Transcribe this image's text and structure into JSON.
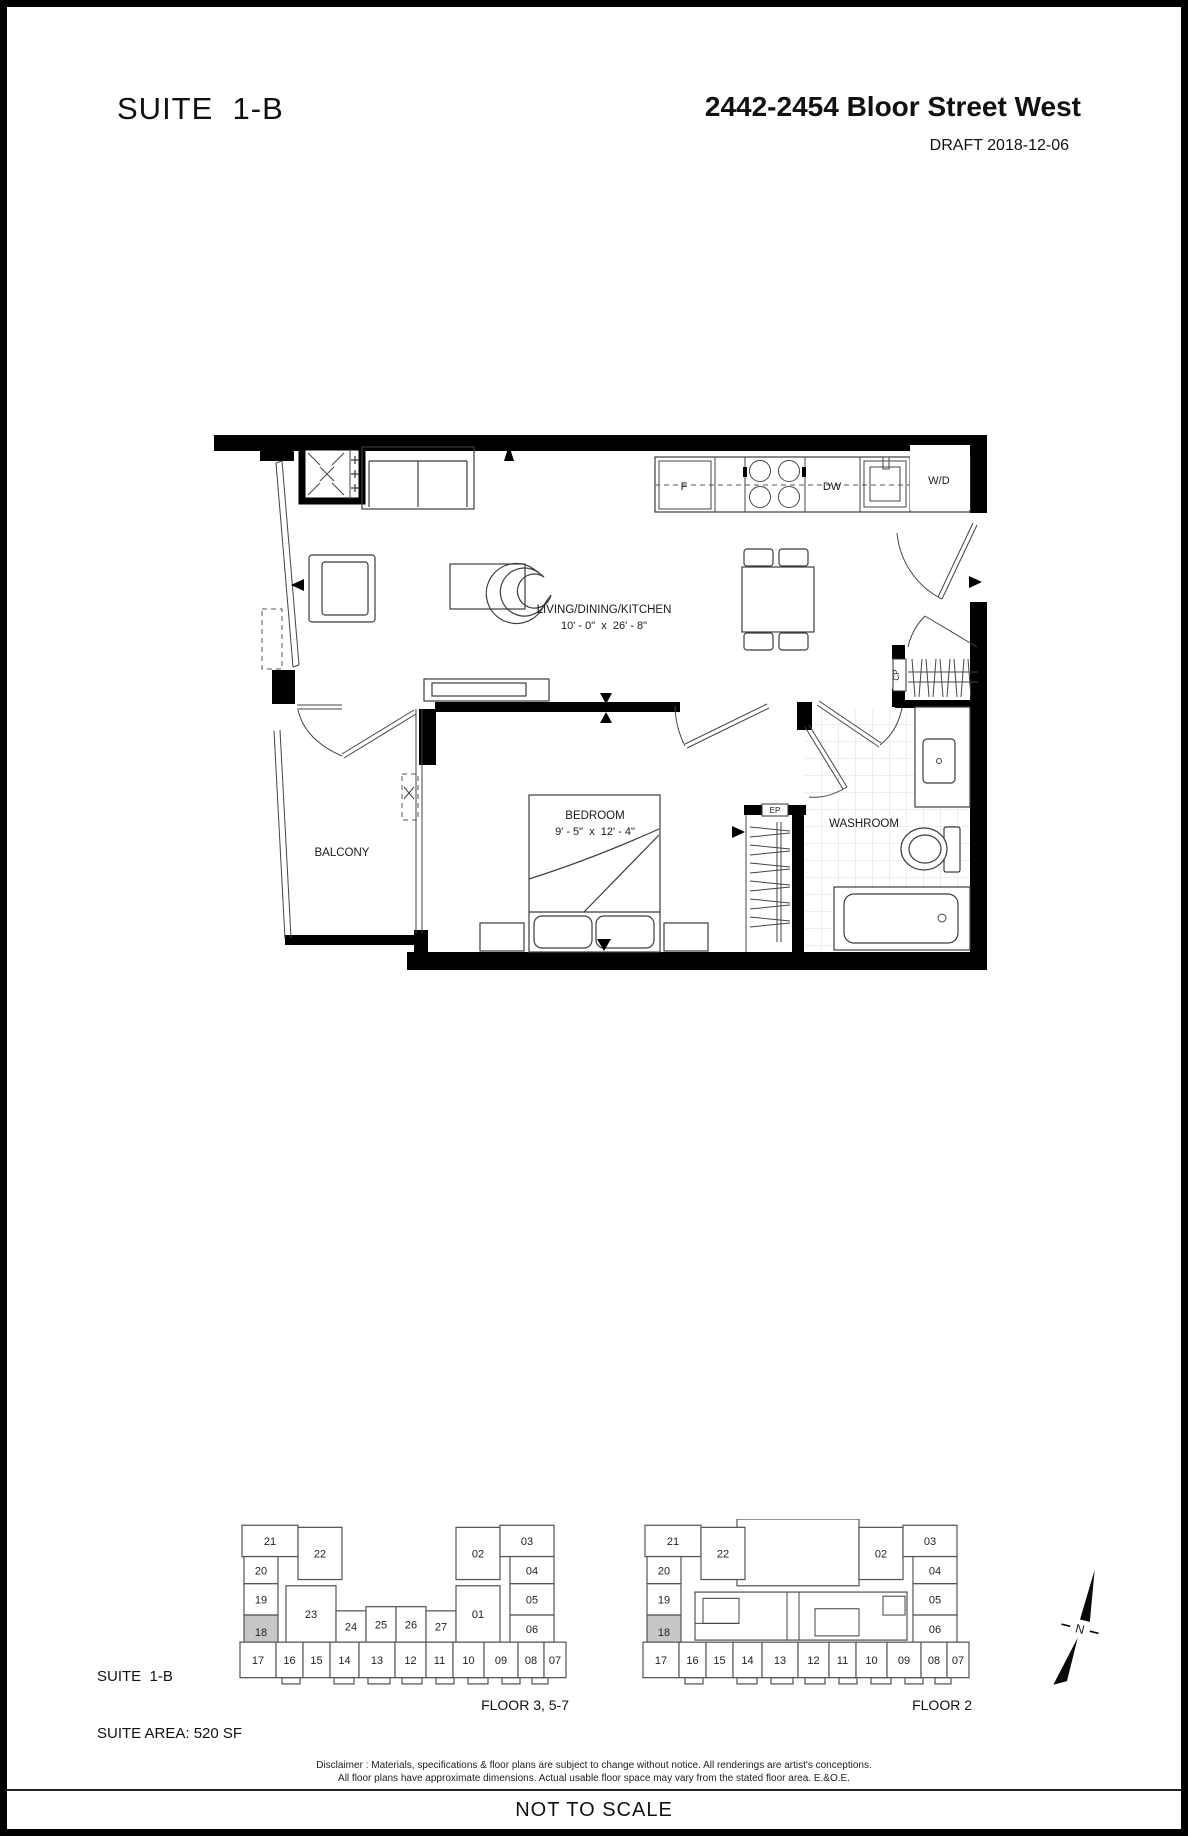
{
  "header": {
    "suite_title": "SUITE  1-B",
    "address": "2442-2454 Bloor Street West",
    "draft": "DRAFT 2018-12-06"
  },
  "plan": {
    "living_label": "LIVING/DINING/KITCHEN",
    "living_dims": "10' - 0\"  x  26' - 8\"",
    "bedroom_label": "BEDROOM",
    "bedroom_dims": "9' - 5\"  x  12' - 4\"",
    "washroom_label": "WASHROOM",
    "balcony_label": "BALCONY",
    "fridge_label": "F",
    "dishwasher_label": "DW",
    "washer_dryer_label": "W/D",
    "coat_closet_label": "CP",
    "electrical_panel_label": "EP"
  },
  "suite_info": {
    "line1": "SUITE  1-B",
    "line2": "SUITE AREA: 520 SF"
  },
  "keyplans": [
    {
      "caption": "FLOOR 3, 5-7",
      "highlighted_unit": "18",
      "units": [
        "21",
        "22",
        "20",
        "19",
        "18",
        "23",
        "24",
        "25",
        "26",
        "27",
        "02",
        "03",
        "01",
        "04",
        "05",
        "06",
        "17",
        "16",
        "15",
        "14",
        "13",
        "12",
        "11",
        "10",
        "09",
        "08",
        "07"
      ]
    },
    {
      "caption": "FLOOR 2",
      "highlighted_unit": "18",
      "units": [
        "21",
        "22",
        "20",
        "19",
        "18",
        "02",
        "03",
        "04",
        "05",
        "06",
        "17",
        "16",
        "15",
        "14",
        "13",
        "12",
        "11",
        "10",
        "09",
        "08",
        "07"
      ]
    }
  ],
  "compass": {
    "label": "N"
  },
  "disclaimer": {
    "line1": "Disclaimer : Materials, specifications & floor plans are subject to change without notice. All renderings are artist's conceptions.",
    "line2": "All floor plans have approximate dimensions. Actual usable floor space may vary from the stated floor area. E.&O.E."
  },
  "footer": {
    "note": "NOT TO SCALE"
  }
}
